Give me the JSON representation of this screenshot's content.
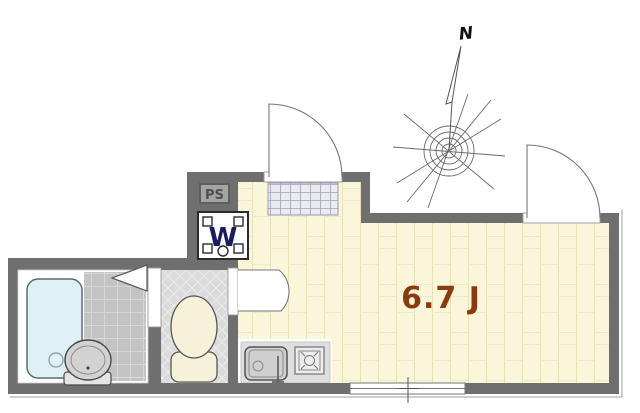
{
  "labels": {
    "room_area": "6.7 J",
    "pipe_space": "PS",
    "washing_machine": "W",
    "compass_north": "N"
  },
  "colors": {
    "wall": "#6f6f6f",
    "room_floor": "#FAF6D9",
    "room_floor_line": "#E8E0B8",
    "room_floor_joint": "#F0E9C6",
    "bath_tile": "#C4C4C4",
    "bath_tile_line": "#D7D7D7",
    "toilet_floor": "#DBDBDB",
    "toilet_floor_line": "#ECECEC",
    "entrance_tile": "#EAEAF1",
    "entrance_tile_line": "#A2A2B5",
    "bathtub_fill": "#E0F1F5",
    "fixture_cream": "#F6F2DA",
    "counter_fill": "#DEDEDE",
    "sink_fill": "#CFCFCF",
    "room_label_text": "#8B3A0F",
    "washer_text": "#1B1B63",
    "pipe_space_text": "#4E4E4E",
    "pipe_space_fill": "#A4A4A4",
    "door_line": "#777777",
    "opening_fill": "#FFFFFF"
  }
}
